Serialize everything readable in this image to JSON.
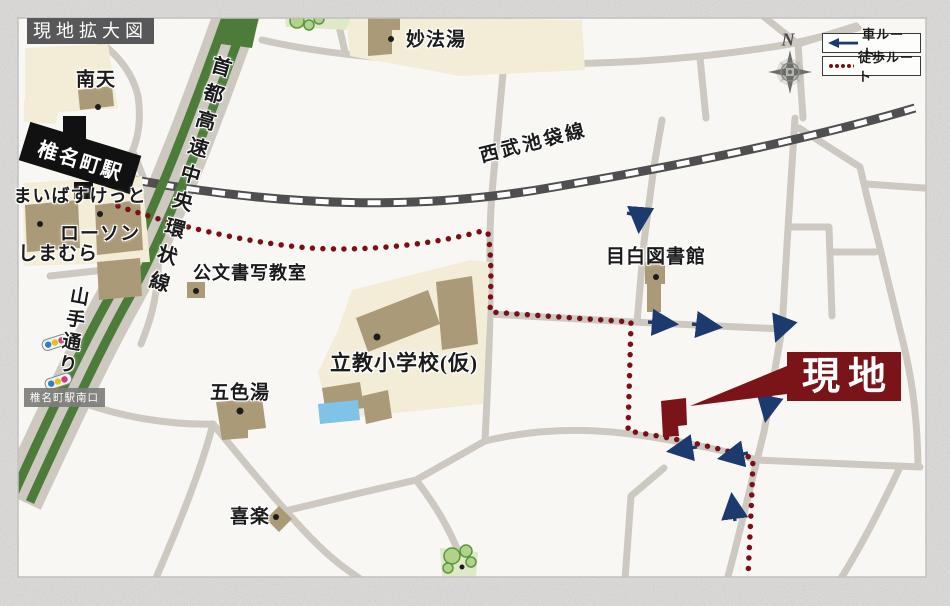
{
  "title": "現地拡大図",
  "legend": {
    "car_label": "車ルート",
    "walk_label": "徒歩ルート"
  },
  "compass": {
    "north": "N"
  },
  "railway": {
    "label": "西武池袋線"
  },
  "highway": {
    "label": "首都高速中央環状線"
  },
  "main_road": {
    "label": "山手通り"
  },
  "station": {
    "name": "椎名町駅",
    "south_exit": "椎名町駅南口"
  },
  "site": {
    "label": "現地"
  },
  "places": {
    "nanten": "南天",
    "myohoyu": "妙法湯",
    "maibasuketto": "まいばすけっと",
    "lawson": "ローソン",
    "shimamura": "しまむら",
    "kumon": "公文書写教室",
    "rikkyo": "立教小学校(仮)",
    "goshikiyu": "五色湯",
    "mejiro_library": "目白図書館",
    "kiraku": "喜楽"
  },
  "colors": {
    "site": "#7a1418",
    "walk_route": "#7a1016",
    "car_route": "#1d3a6e",
    "highway": "#4d7c3a",
    "road": "#cdc9c0",
    "cream": "#f3edd8",
    "building": "#ab9a78",
    "railway": "#4f4f4f",
    "pool": "#7fc3e8",
    "paper": "#dddcda",
    "map_bg": "#f8f7f4"
  }
}
